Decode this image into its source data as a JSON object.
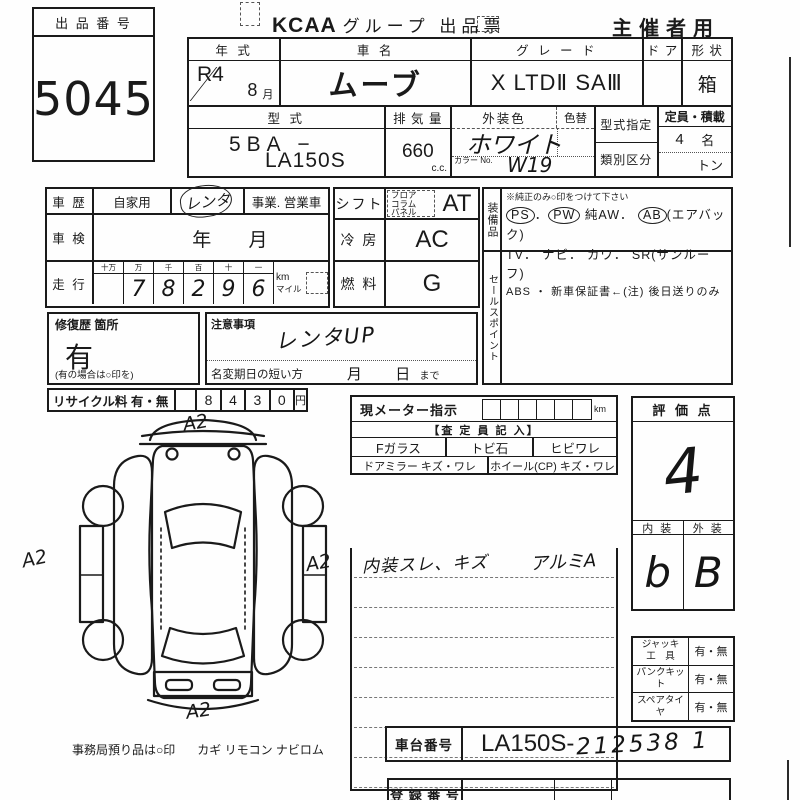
{
  "header": {
    "lot_label": "出 品 番 号",
    "lot_number": "5045",
    "brand": "KCAA",
    "title": "グループ 出品票",
    "audience": "主催者用"
  },
  "vehicle": {
    "year": {
      "label": "年 式",
      "era": "R4",
      "month": "8",
      "month_suffix": "月"
    },
    "name": {
      "label": "車 名",
      "value": "ムーブ"
    },
    "grade": {
      "label": "グ レ ー ド",
      "value": "X LTDⅡ SAⅢ"
    },
    "door": {
      "label": "ド ア",
      "value": ""
    },
    "shape": {
      "label": "形 状",
      "value": "箱"
    },
    "model": {
      "label": "型 式",
      "line1": "5BA −",
      "line2": "LA150S"
    },
    "displacement": {
      "label": "排 気 量",
      "value": "660",
      "unit": "c.c."
    },
    "ext_color": {
      "label": "外装色",
      "value": "ホワイト",
      "change_label": "色替",
      "color_no_label": "カラー No.",
      "color_no": "W19"
    },
    "type_cert_label": "型式指定",
    "class_div_label": "類別区分",
    "capacity": {
      "label": "定員・積載",
      "persons": "4",
      "persons_unit": "名",
      "load_unit": "トン"
    }
  },
  "history": {
    "label": "車 歴",
    "private": "自家用",
    "rental": "レンタ",
    "business": "事業. 営業車",
    "inspection": {
      "label": "車 検",
      "year": "年",
      "month": "月"
    },
    "mileage": {
      "label": "走 行",
      "digit_headers": [
        "十万",
        "万",
        "千",
        "百",
        "十",
        "一"
      ],
      "digits": [
        "",
        "7",
        "8",
        "2",
        "9",
        "6"
      ],
      "unit_km": "km",
      "unit_mile": "マイル"
    },
    "repair": {
      "label": "修復歴 箇所",
      "value": "有",
      "note": "(有の場合は○印を)"
    },
    "caution": {
      "label": "注意事項",
      "value": "レンタUP"
    },
    "rename": {
      "label": "名変期日の短い方",
      "month": "月",
      "day": "日",
      "suffix": "まで"
    },
    "recycle": {
      "label": "リサイクル料 有・無",
      "digits": [
        "8",
        "4",
        "3",
        "0"
      ],
      "unit": "円"
    }
  },
  "drivetrain": {
    "shift": {
      "label": "シフト",
      "options": [
        "フロア",
        "コラム",
        "パネル"
      ],
      "value": "AT"
    },
    "cooling": {
      "label": "冷 房",
      "value": "AC"
    },
    "fuel": {
      "label": "燃 料",
      "value": "G"
    }
  },
  "equipment": {
    "label": "装備品",
    "note": "※純正のみ○印をつけて下さい",
    "line1": [
      {
        "t": "PS",
        "circled": true
      },
      {
        "t": "．",
        "circled": false
      },
      {
        "t": "PW",
        "circled": true
      },
      {
        "t": " 純AW．",
        "circled": false
      },
      {
        "t": "AB",
        "circled": true
      },
      {
        "t": "(エアバック)",
        "circled": false
      }
    ],
    "line2": "TV． ナビ． カワ． SR(サンルーフ)",
    "line3": "ABS ・ 新車保証書←(注) 後日送りのみ",
    "sales_label": "セールスポイント"
  },
  "assessment": {
    "meter_label": "現メーター指示",
    "meter_unit": "km",
    "appraiser_header": "【査 定 員 記 入】",
    "checks_row1": [
      "Fガラス",
      "トビ石",
      "ヒビワレ"
    ],
    "checks_row2": [
      "ドアミラー キズ・ワレ",
      "ホイール(CP) キズ・ワレ"
    ],
    "notes_left": "内装スレ、キズ",
    "notes_right": "アルミA"
  },
  "score": {
    "label": "評 価 点",
    "value": "4",
    "interior_label": "内 装",
    "exterior_label": "外 装",
    "interior": "b",
    "exterior": "B"
  },
  "accessories": {
    "rows": [
      {
        "label": "ジャッキ\n工　具",
        "value": "有・無"
      },
      {
        "label": "パンクキット",
        "value": "有・無"
      },
      {
        "label": "スペアタイヤ",
        "value": "有・無"
      }
    ]
  },
  "ids": {
    "chassis_label": "車台番号",
    "chassis_printed": "LA150S-",
    "chassis_written": "212538 1",
    "registration_label": "登 録 番 号"
  },
  "diagram": {
    "marks": [
      "A2",
      "A2",
      "A2",
      "A2"
    ]
  },
  "footer": {
    "office_note": "事務局預り品は○印",
    "office_items": "カギ リモコン ナビロム"
  }
}
